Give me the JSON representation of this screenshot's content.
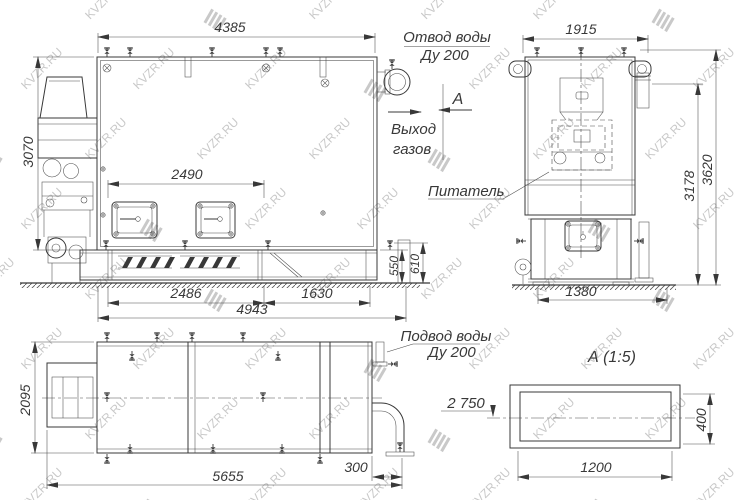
{
  "watermark": {
    "text": "KVZR.RU"
  },
  "side_view": {
    "dim_width_top": "4385",
    "dim_height_left": "3070",
    "dim_hatch_pitch": "2490",
    "dim_bottom_left": "2486",
    "dim_bottom_right": "1630",
    "dim_bottom_overall": "4943",
    "dim_base_height": "550",
    "dim_base_height2": "610",
    "water_outlet_label": "Отвод воды",
    "water_outlet_size": "Ду 200",
    "gas_exit_line1": "Выход",
    "gas_exit_line2": "газов",
    "view_arrow_letter": "А"
  },
  "front_view": {
    "dim_width_top": "1915",
    "dim_height_inner": "3178",
    "dim_height_overall": "3620",
    "dim_width_bottom": "1380",
    "feeder_label": "Питатель"
  },
  "plan_view": {
    "dim_height_left": "2095",
    "dim_width_overall": "5655",
    "dim_outlet_offset": "300",
    "water_inlet_label": "Подвод воды",
    "water_inlet_size": "Ду 200",
    "level_mark": "2 750"
  },
  "detail_view": {
    "title": "А  (1:5)",
    "dim_width": "1200",
    "dim_height": "400"
  }
}
